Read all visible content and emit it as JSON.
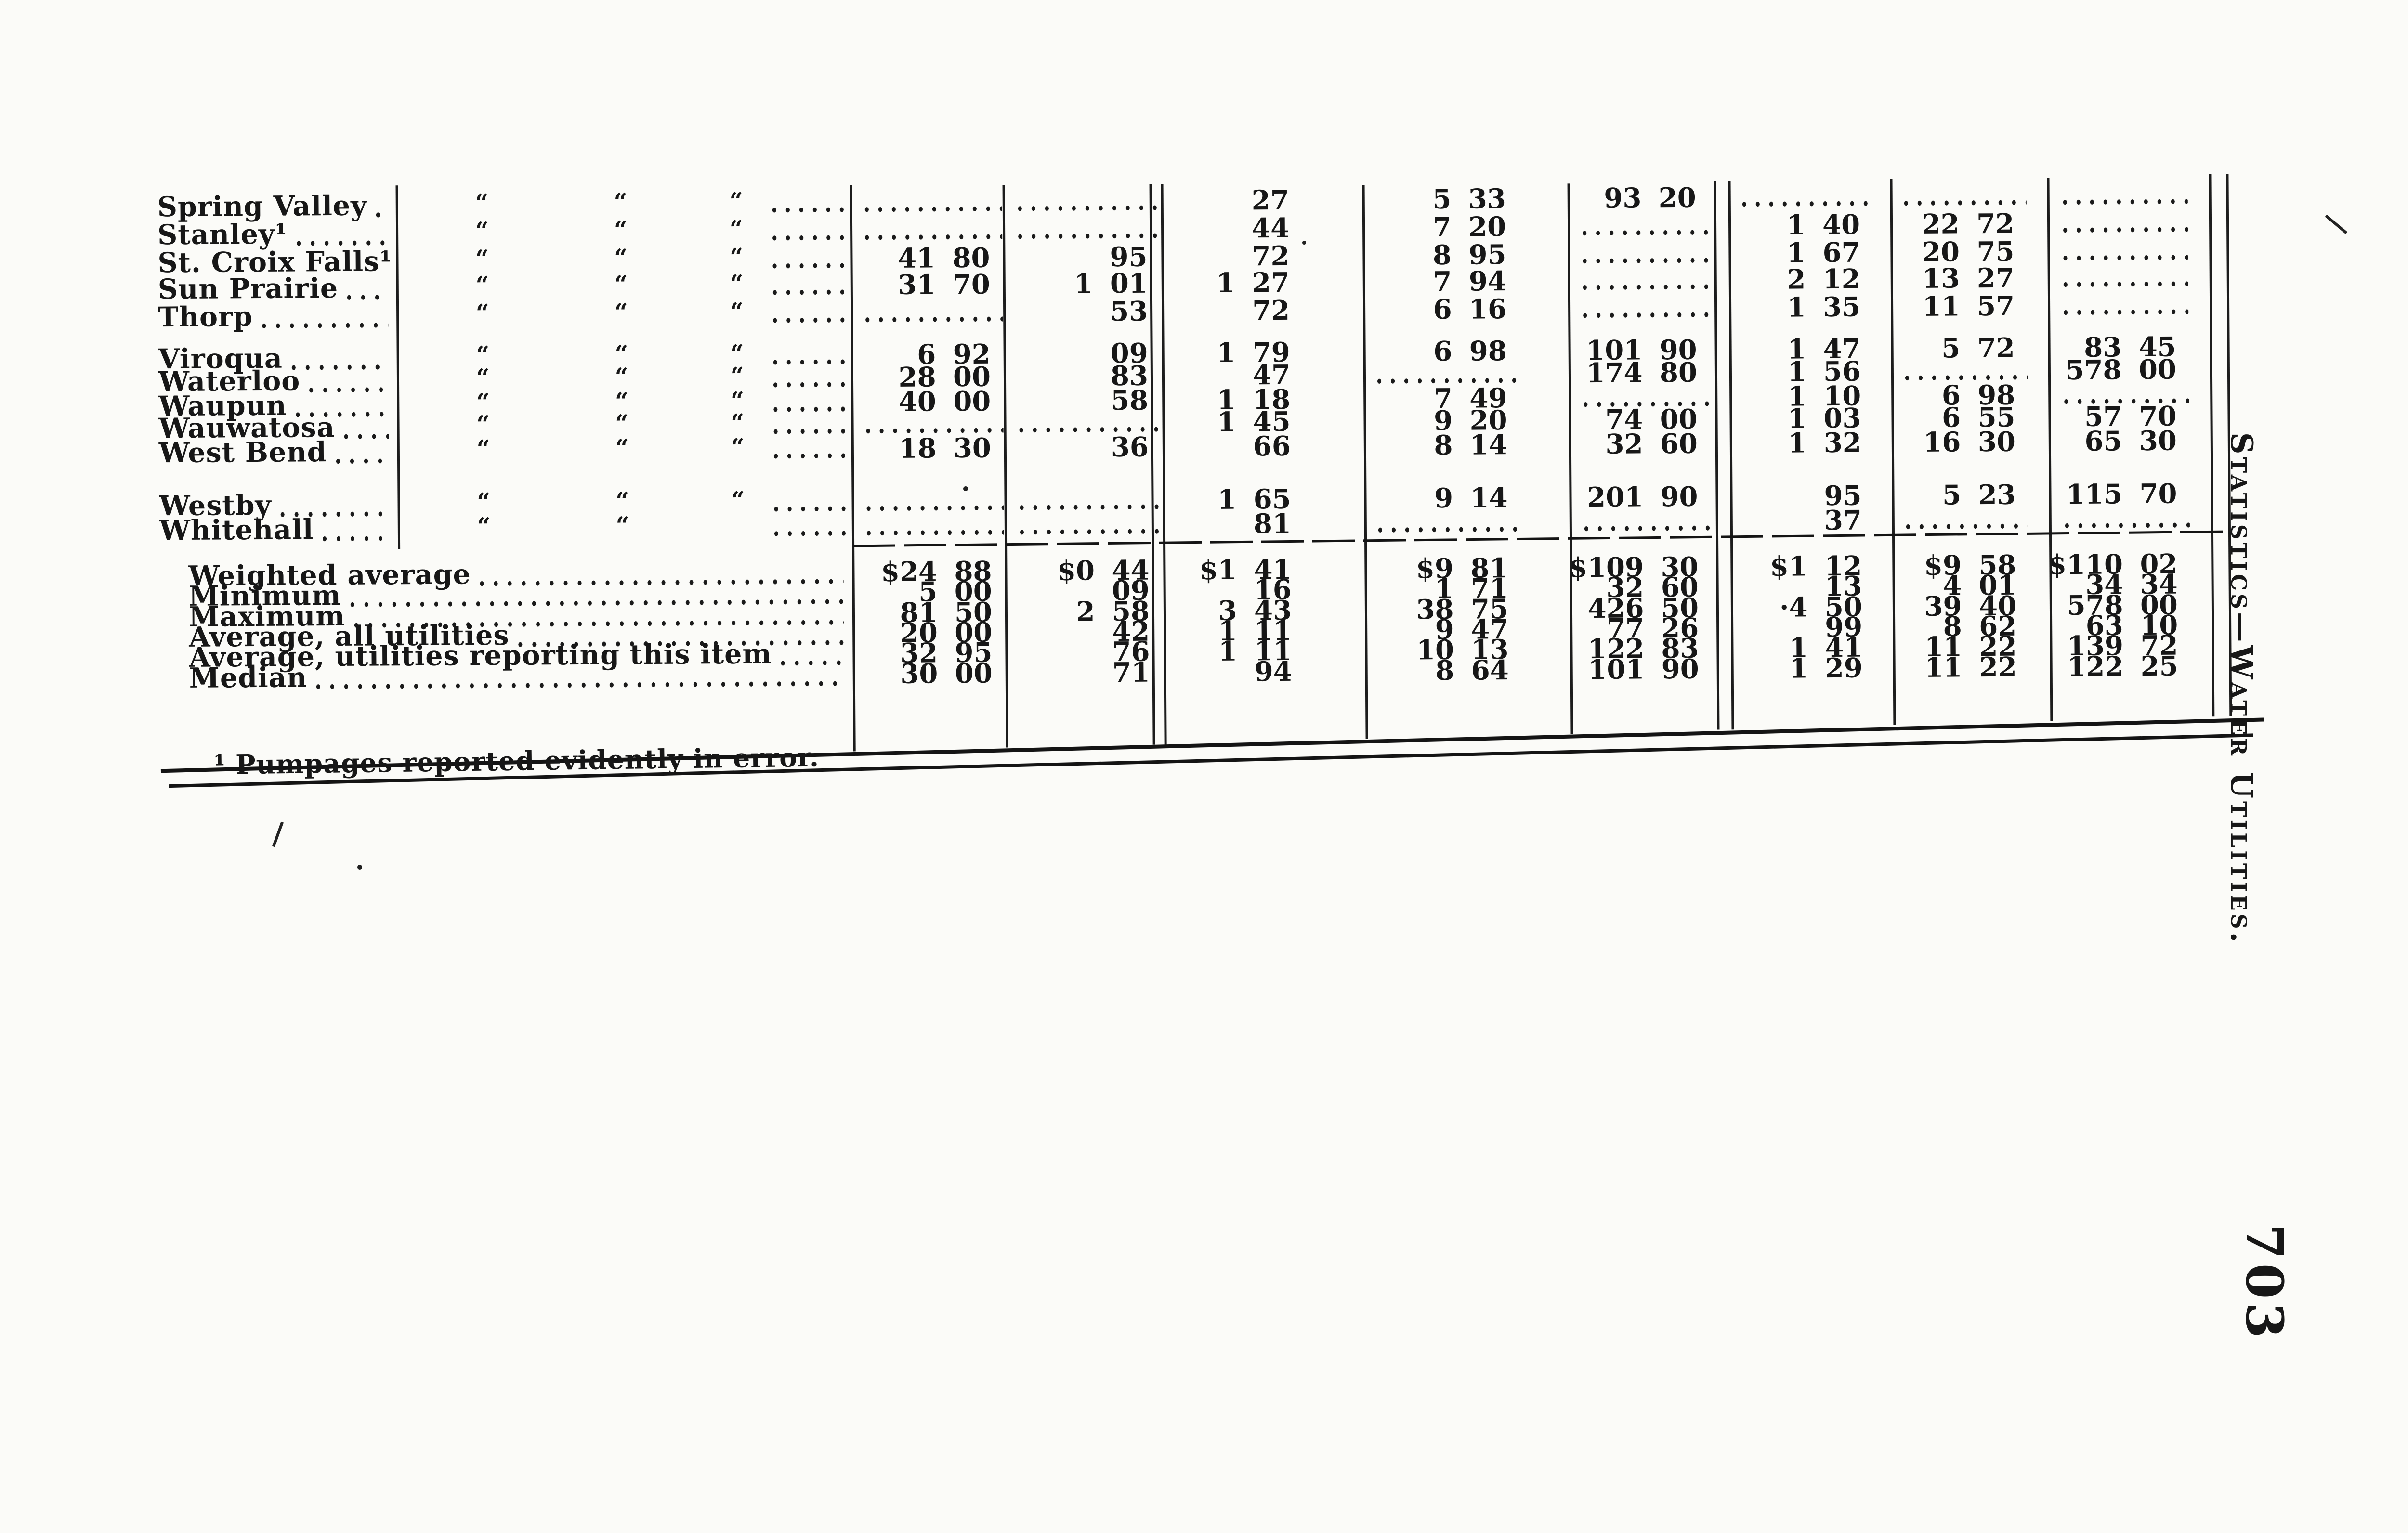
{
  "page": {
    "background": "#fbfbf8",
    "ink": "#171717",
    "side_title": "Statistics—Water Utilities.",
    "page_number": "703",
    "footnote": "¹ Pumpages reported evidently in error."
  },
  "table": {
    "ditto_mark": "“",
    "rows": [
      {
        "label": "Spring Valley",
        "dittos": 3,
        "cells": [
          null,
          null,
          "27",
          "5 33",
          "93 20",
          null,
          null,
          null
        ]
      },
      {
        "label": "Stanley¹",
        "dittos": 3,
        "cells": [
          null,
          null,
          "44",
          "7 20",
          null,
          "1 40",
          "22 72",
          null
        ]
      },
      {
        "label": "St. Croix Falls¹",
        "dittos": 3,
        "cells": [
          "41 80",
          "95",
          "72",
          "8 95",
          null,
          "1 67",
          "20 75",
          null
        ]
      },
      {
        "label": "Sun Prairie",
        "dittos": 3,
        "cells": [
          "31 70",
          "1 01",
          "1 27",
          "7 94",
          null,
          "2 12",
          "13 27",
          null
        ]
      },
      {
        "label": "Thorp",
        "dittos": 3,
        "cells": [
          null,
          "53",
          "72",
          "6 16",
          null,
          "1 35",
          "11 57",
          null
        ]
      },
      {
        "label": "Viroqua",
        "dittos": 3,
        "cells": [
          "6 92",
          "09",
          "1 79",
          "6 98",
          "101 90",
          "1 47",
          "5 72",
          "83 45"
        ]
      },
      {
        "label": "Waterloo",
        "dittos": 3,
        "cells": [
          "28 00",
          "83",
          "47",
          null,
          "174 80",
          "1 56",
          null,
          "578 00"
        ]
      },
      {
        "label": "Waupun",
        "dittos": 3,
        "cells": [
          "40 00",
          "58",
          "1 18",
          "7 49",
          null,
          "1 10",
          "6 98",
          null
        ]
      },
      {
        "label": "Wauwatosa",
        "dittos": 3,
        "cells": [
          null,
          null,
          "1 45",
          "9 20",
          "74 00",
          "1 03",
          "6 55",
          "57 70"
        ]
      },
      {
        "label": "West Bend",
        "dittos": 3,
        "cells": [
          "18 30",
          "36",
          "66",
          "8 14",
          "32 60",
          "1 32",
          "16 30",
          "65 30"
        ]
      },
      {
        "label": "Westby",
        "dittos": 3,
        "cells": [
          null,
          null,
          "1 65",
          "9 14",
          "201 90",
          "95",
          "5 23",
          "115 70"
        ]
      },
      {
        "label": "Whitehall",
        "dittos": 2,
        "cells": [
          null,
          null,
          "81",
          null,
          null,
          "37",
          null,
          null
        ]
      }
    ],
    "summary_rows": [
      {
        "label": "Weighted average",
        "cells": [
          "$24 88",
          "$0 44",
          "$1 41",
          "$9 81",
          "$109 30",
          "$1 12",
          "$9 58",
          "$110 02"
        ]
      },
      {
        "label": "Minimum",
        "cells": [
          "5 00",
          "09",
          "16",
          "1 71",
          "32 60",
          "13",
          "4 01",
          "34 34"
        ]
      },
      {
        "label": "Maximum",
        "cells": [
          "81 50",
          "2 58",
          "3 43",
          "38 75",
          "426 50",
          "·4 50",
          "39 40",
          "578 00"
        ]
      },
      {
        "label": "Average, all utilities",
        "cells": [
          "20 00",
          "42",
          "1 11",
          "9 47",
          "77 26",
          "99",
          "8 62",
          "63 10"
        ]
      },
      {
        "label": "Average, utilities reporting this item",
        "cells": [
          "32 95",
          "76",
          "1 11",
          "10 13",
          "122 83",
          "1 41",
          "11 22",
          "139 72"
        ]
      },
      {
        "label": "Median",
        "cells": [
          "30 00",
          "71",
          "94",
          "8 64",
          "101 90",
          "1 29",
          "11 22",
          "122 25"
        ]
      }
    ]
  }
}
